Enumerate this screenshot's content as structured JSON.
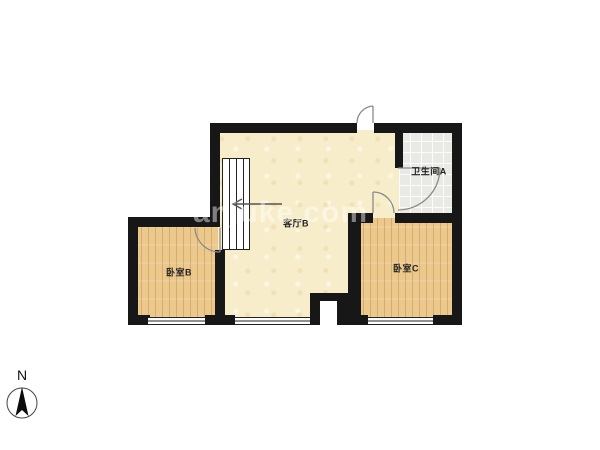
{
  "rooms": {
    "living": {
      "label": "客厅B"
    },
    "bathroom": {
      "label": "卫生间A"
    },
    "bedroom_b": {
      "label": "卧室B"
    },
    "bedroom_c": {
      "label": "卧室C"
    }
  },
  "compass": {
    "north_label": "N"
  },
  "watermark": {
    "text": "anjuke.com"
  },
  "colors": {
    "wall": "#171717",
    "living_floor": "#f7edca",
    "wood_floor": "#ecc88d",
    "bathroom_floor": "#e9e9e5",
    "door_stroke": "#8a8a8a",
    "background": "#ffffff"
  }
}
